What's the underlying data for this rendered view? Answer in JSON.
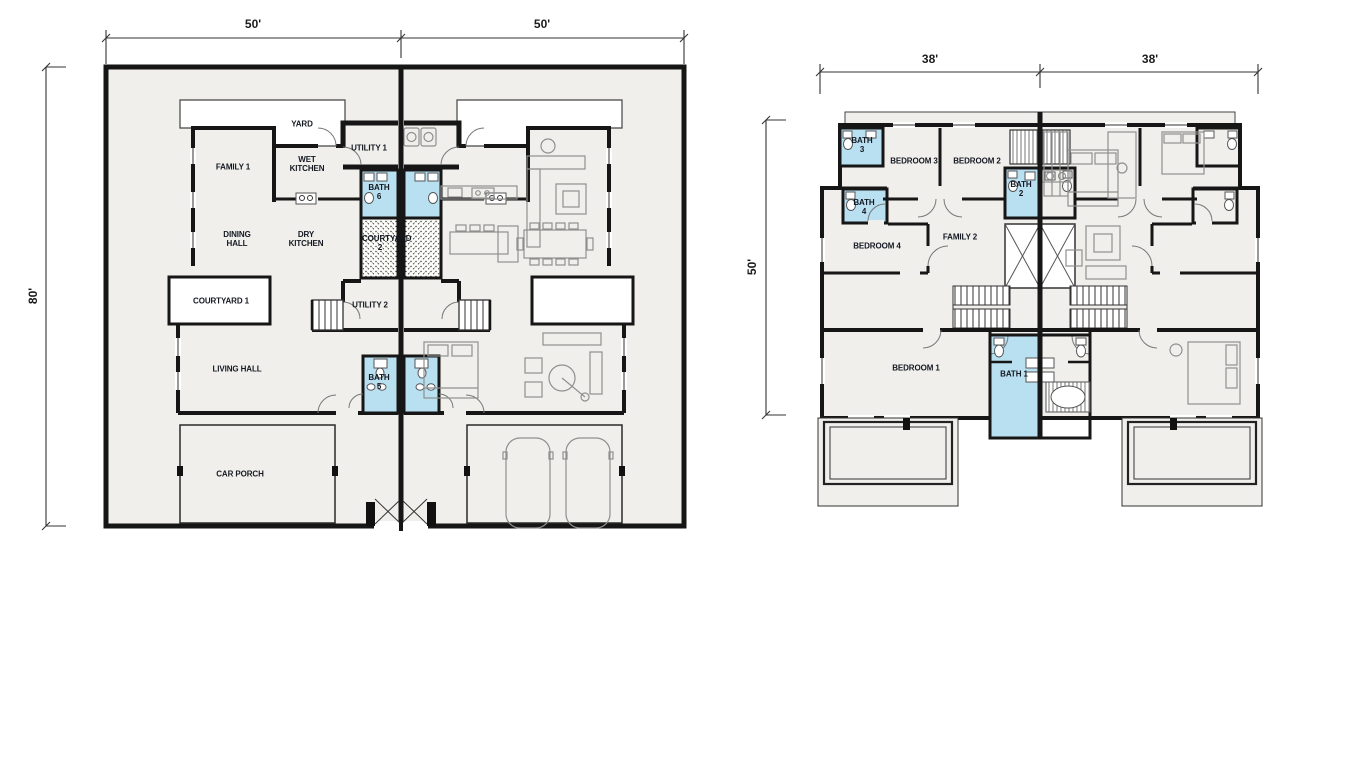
{
  "colors": {
    "bath_fill": "#b9e0f1",
    "floor_fill": "#f0efec",
    "wall": "#161616",
    "label_text": "#141821"
  },
  "ground_floor": {
    "dimensions": {
      "top_left": "50'",
      "top_right": "50'",
      "side": "80'"
    },
    "rooms": {
      "yard": "YARD",
      "utility_1": "UTILITY 1",
      "family_1": "FAMILY 1",
      "wet_kitchen": "WET KITCHEN",
      "bath_6": "BATH 6",
      "dining_hall": "DINING HALL",
      "dry_kitchen": "DRY KITCHEN",
      "courtyard_2": "COURTYARD 2",
      "courtyard_1": "COURTYARD 1",
      "utility_2": "UTILITY 2",
      "living_hall": "LIVING HALL",
      "bath_5": "BATH 5",
      "car_porch": "CAR PORCH"
    }
  },
  "first_floor": {
    "dimensions": {
      "top_left": "38'",
      "top_right": "38'",
      "side": "50'"
    },
    "rooms": {
      "bath_3": "BATH 3",
      "bedroom_3": "BEDROOM 3",
      "bedroom_2": "BEDROOM 2",
      "bath_2": "BATH 2",
      "bath_4": "BATH 4",
      "bedroom_4": "BEDROOM 4",
      "family_2": "FAMILY 2",
      "bedroom_1": "BEDROOM 1",
      "bath_1": "BATH 1"
    }
  }
}
